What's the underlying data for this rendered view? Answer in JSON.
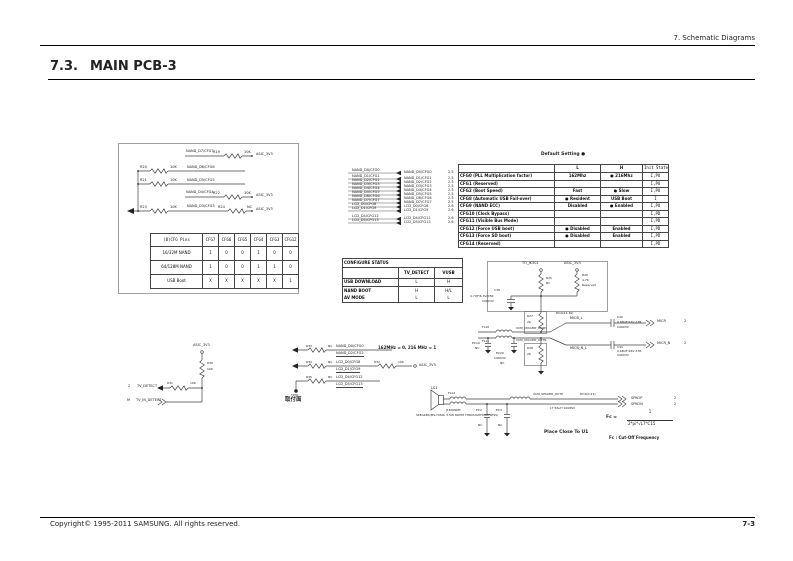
{
  "page": {
    "header_right": "7.  Schematic  Diagrams",
    "section_no": "7.3.",
    "title": "MAIN PCB-3",
    "footer_left": "Copyright© 1995-2011 SAMSUNG. All rights reserved.",
    "footer_right": "7-3"
  },
  "pullup_block": {
    "rows": [
      {
        "net": "NAND_D7/CFG7",
        "res": "R19",
        "val": "10K",
        "rail": "ASIC_3V3"
      },
      {
        "res": "R20",
        "val": "10K",
        "net": "NAND_D6/CFG6"
      },
      {
        "res": "R21",
        "val": "10K",
        "net": "NAND_D5/CFG5"
      },
      {
        "net": "NAND_D4/CFG4",
        "res": "R22",
        "val": "10K",
        "rail": "ASIC_3V3"
      },
      {
        "res": "R23",
        "val": "10K",
        "net": "NAND_D3/CFG3",
        "res2": "R24",
        "val2": "NC",
        "rail": "ASIC_3V3"
      }
    ]
  },
  "cfg_table": {
    "headers": [
      "(B)CFG Pins",
      "CFG7",
      "CFG6",
      "CFG5",
      "CFG4",
      "CFG3",
      "CFG12"
    ],
    "rows": [
      [
        "16/32M NAND",
        "1",
        "0",
        "0",
        "1",
        "0",
        "0"
      ],
      [
        "64/128M NAND",
        "1",
        "0",
        "0",
        "1",
        "1",
        "0"
      ],
      [
        "USB Boot",
        "X",
        "X",
        "X",
        "X",
        "X",
        "1"
      ]
    ]
  },
  "signal_list": {
    "rows": [
      {
        "name": "NAND_D0/CFG0",
        "ref": "2.5"
      },
      {
        "name": "NAND_D1/CFG1",
        "ref": "2.5"
      },
      {
        "name": "NAND_D2/CFG2",
        "ref": "2.5"
      },
      {
        "name": "NAND_D3/CFG3",
        "ref": "2.5"
      },
      {
        "name": "NAND_D4/CFG4",
        "ref": "2.5"
      },
      {
        "name": "NAND_D5/CFG5",
        "ref": "2.5"
      },
      {
        "name": "NAND_D6/CFG6",
        "ref": "2.5"
      },
      {
        "name": "NAND_D7/CFG7",
        "ref": "2.5"
      },
      {
        "name": "LCD_D0/CFG8",
        "ref": "2.6"
      },
      {
        "name": "LCD_D1/CFG9",
        "ref": "2.6"
      },
      {
        "name": "LCD_D4/CFG12",
        "ref": "2.6"
      },
      {
        "name": "LCD_D5/CFG13",
        "ref": "2.6"
      }
    ]
  },
  "configure_status": {
    "title": "CONFIGURE STATUS",
    "col1": "TV_DETECT",
    "col2": "VUSB",
    "rows": [
      {
        "mode": "USB DOWNLOAD",
        "tv": "L",
        "vusb": "H"
      },
      {
        "mode": "NAND BOOT",
        "tv": "H",
        "vusb": "H/L"
      },
      {
        "mode": "AV MODE",
        "tv": "L",
        "vusb": "L"
      }
    ]
  },
  "default_setting": {
    "caption": "Default Setting ●",
    "headers": [
      "",
      "L",
      "H",
      "Init State"
    ],
    "rows": [
      {
        "label": "CFG0 (PLL Multiplication factor)",
        "l": "162Mhz",
        "h": "● 216Mhz",
        "init": "I,PU"
      },
      {
        "label": "CFG1 (Reserved)",
        "l": "",
        "h": "",
        "init": "I,PU"
      },
      {
        "label": "CFG2 (Boot Speed)",
        "l": "Fast",
        "h": "● Slow",
        "init": "I,PU"
      },
      {
        "label": "CFG8 (Automatic USB Fail-over)",
        "l": "● Resident",
        "h": "USB Boot",
        "init": "I"
      },
      {
        "label": "CFG9 (NAND ECC)",
        "l": "Disabled",
        "h": "● Enabled",
        "init": "I,PU"
      },
      {
        "label": "CFG10 (Clock Bypass)",
        "l": "",
        "h": "",
        "init": "I,PD"
      },
      {
        "label": "CFG11 (Visible Bus Mode)",
        "l": "",
        "h": "",
        "init": "I,PD"
      },
      {
        "label": "CFG12 (Force USB boot)",
        "l": "● Disabled",
        "h": "Enabled",
        "init": "I,PD"
      },
      {
        "label": "CFG13 (Force SD boot)",
        "l": "● Disabled",
        "h": "Enabled",
        "init": "I,PD"
      },
      {
        "label": "CFG14 (Reserved)",
        "l": "",
        "h": "",
        "init": "I,PD"
      }
    ]
  },
  "micbias": {
    "net_left": "TO_JK301",
    "rail": "ASIC_3V3",
    "r25": "R25",
    "r25_val": "NC",
    "r26": "R26",
    "r26_val": "4.7K",
    "r26_note": "Reserved",
    "c38": "C38",
    "c38_val": "4.7UF/6.3V/X5R",
    "c38_pkg": "C0603V",
    "r27": "R27",
    "r27_val": "2K",
    "r28": "R28",
    "r28_val": "2K",
    "fl10": "FL10",
    "fl11": "FL11",
    "outp": "VCM_MICAMP_OUTP",
    "outn": "VCM_MICAMP_OUTN",
    "micb_l": "MICB_L",
    "micb_nl": "MICB_N_L",
    "trace_note": "8mil(14.30)",
    "ec19": "EC19",
    "ec19_val": "NC",
    "ec20": "EC20",
    "ec20_pkg": "C0603V",
    "ec20_val": "NC",
    "c40": "C40",
    "c40_val": "0.68UF/16V X7R",
    "c40_pkg": "C0603V",
    "c41": "C41",
    "c41_val": "0.68UF/16V X7R",
    "c41_pkg": "C0603V",
    "micr": "MICR",
    "micr_ref": "2",
    "micr_n": "MICR_N",
    "micr_n_ref": "2"
  },
  "speaker": {
    "ls1": "LS1",
    "jref": "J1800SMT",
    "desc": "SPEAKER(MS-Y050L 3.5W 8OHM THROUGHHOLE/SESS)",
    "fl12": "FL12",
    "outp": "VCM_SPKAMP_OUTP",
    "trace_note": "8mil(0.23)",
    "l7": "L7  56uH  1008SV",
    "ec2": "EC2",
    "ec2_val": "NC",
    "ec3": "EC3",
    "ec3_val": "NC",
    "spkop": "SPKOP",
    "spkop_ref": "2",
    "spkon": "SPKON",
    "spkon_ref": "2",
    "place_note": "Place Close To U1",
    "fc_label": "Fc =",
    "fc_num": "1",
    "fc_den_a": "2*pi*",
    "fc_den_b": "√L7*C15",
    "fc_note": "Fc : Cut-Off Frequency"
  },
  "tv_detect": {
    "rail": "ASIC_3V3",
    "r30": "R30",
    "r30_val": "10K",
    "ref1": "2",
    "net1": "TV_DETECT",
    "r31": "R31",
    "r31_val": "10K",
    "ref2": "M",
    "net2": "TV_IN_DETECT"
  },
  "straps": {
    "note": "162MHz = 0, 216 MHz = 1",
    "rows": [
      {
        "r": "R33",
        "rv": "NC",
        "top": "NAND_D0/CFG0",
        "bot": "NAND_D2/CFG2"
      },
      {
        "r": "R34",
        "rv": "NC",
        "top": "LCD_D0/CFG8",
        "bot": "LCD_D1/CFG9",
        "r2": "R32",
        "r2v": "10K",
        "rail": "ASIC_3V3"
      },
      {
        "r": "R35",
        "rv": "NC",
        "top": "LCD_D4/CFG12",
        "bot": "LCD_D5/CFG13"
      }
    ],
    "tp": "TP30",
    "tp_note": "取付面"
  }
}
